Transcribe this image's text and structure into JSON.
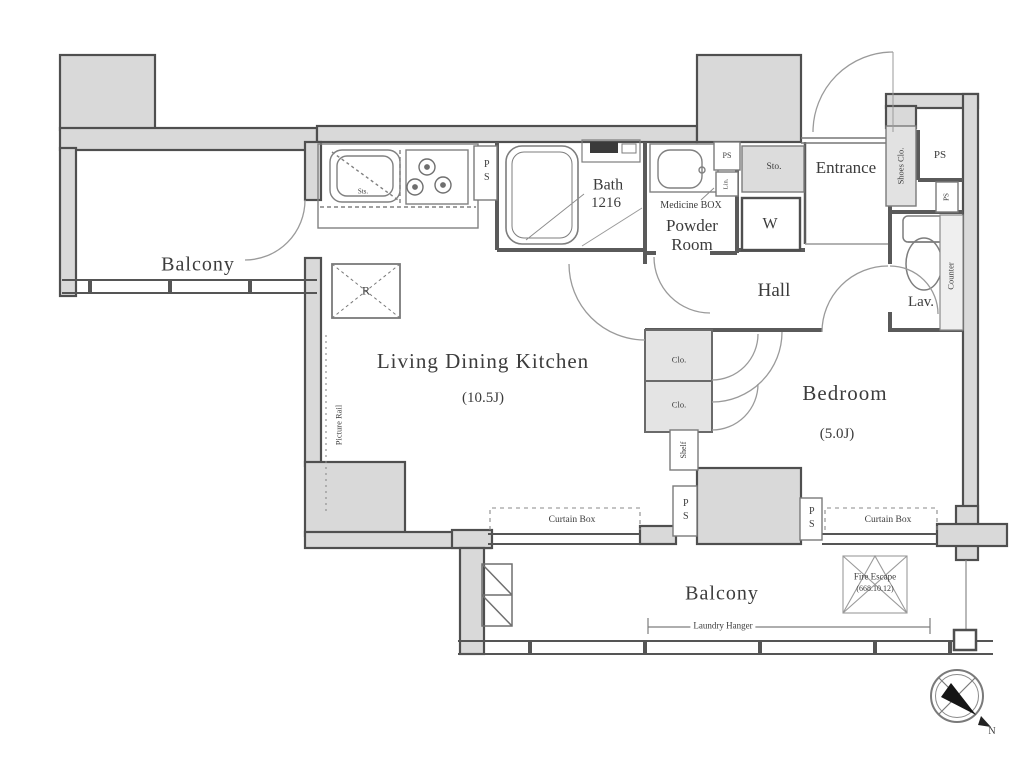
{
  "colors": {
    "wall_fill": "#d9d9d9",
    "wall_stroke": "#4f4f4f",
    "thin_line": "#8c8c8c",
    "text": "#3c3c3c"
  },
  "rooms": {
    "balcony_left": "Balcony",
    "balcony_bottom": "Balcony",
    "ldk": {
      "name": "Living Dining Kitchen",
      "size": "(10.5J)"
    },
    "bedroom": {
      "name": "Bedroom",
      "size": "(5.0J)"
    },
    "hall": "Hall",
    "entrance": "Entrance",
    "bath": {
      "name": "Bath",
      "size": "1216"
    },
    "powder_room": {
      "line1": "Powder",
      "line2": "Room"
    },
    "lav": "Lav."
  },
  "labels": {
    "medicine_box": "Medicine BOX",
    "washer": "W",
    "storage": "Sto.",
    "shoes_closet": "Shoes Clo.",
    "counter": "Counter",
    "closet": "Clo.",
    "shelf": "Shelf",
    "picture_rail": "Picture Rail",
    "refrigerator": "R",
    "sink": "Sts.",
    "linen": "Lin.",
    "pipe_shaft": "PS",
    "curtain_box": "Curtain Box",
    "laundry_hanger": "Laundry Hanger",
    "fire_escape_line1": "Fire Escape",
    "fire_escape_line2": "(668.10.12)",
    "compass_north": "N"
  }
}
